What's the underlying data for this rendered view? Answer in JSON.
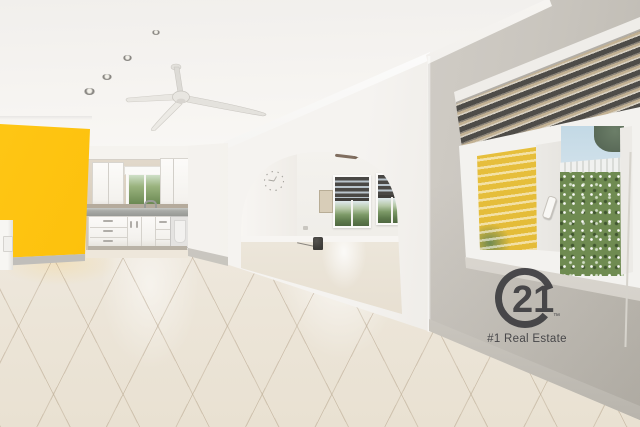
{
  "scene": {
    "type": "real-estate interior photo",
    "description": "Empty open-plan living room with glossy tile floor, yellow accent wall, white kitchen, ceiling fan, archway to second room, and garden-view windows with zebra blinds",
    "watermark": {
      "brand_number": "21",
      "trademark": "™",
      "tagline": "#1 Real Estate",
      "color": "#3d3d40"
    },
    "fixtures": {
      "ceiling_fans": 2,
      "recessed_lights": 4,
      "windows": 4,
      "wall_clock": 1,
      "light_switch": 1
    },
    "colors": {
      "accent_wall_yellow": "#fbbb02",
      "ceiling_white": "#f6f4f1",
      "wall_white": "#f2f0ec",
      "right_wall_gray": "#d0ccc5",
      "kitchen_wall_beige": "#dcd2c3",
      "cabinet_white": "#faf9f6",
      "countertop_gray": "#a9aba7",
      "floor_tile": "#ece5d8",
      "grout": "#b3a187",
      "zebra_blind_dark": "#4e4c48",
      "foliage_green": "#6f8b51",
      "sky_blue": "#c3d9e5",
      "exterior_house_yellow": "#e3ba36"
    }
  }
}
